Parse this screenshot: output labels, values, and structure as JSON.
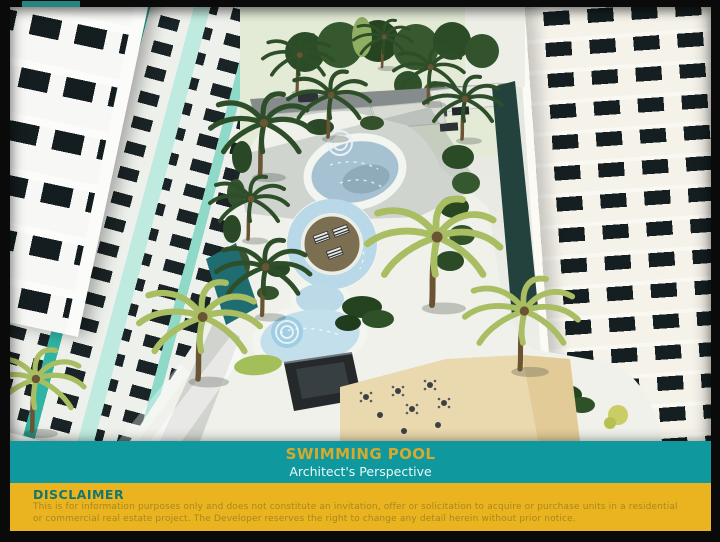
{
  "slide": {
    "image_alt": "Aerial architect's rendering of a free-form swimming pool courtyard with palm trees, lounger island and amenity deck between mid-rise residential towers",
    "caption": {
      "title": "SWIMMING POOL",
      "subtitle": "Architect's Perspective"
    },
    "disclaimer": {
      "heading": "DISCLAIMER",
      "line1": "This is for information purposes only and does not constitute an invitation, offer or solicitation to acquire or purchase units in a residential",
      "line2": "or commercial real estate project. The Developer reserves the right to change any detail herein without prior notice."
    }
  },
  "colors": {
    "frame_black": "#0a0a0a",
    "banner_teal": "#0f989e",
    "banner_title": "#d5aa2d",
    "banner_subtitle": "#e9fbf8",
    "disclaimer_bg": "#e9b41f",
    "disclaimer_heading": "#16756d",
    "disclaimer_text": "#a8871f",
    "pool_water": "#b9d8e8",
    "mint_facade": "#8fd9c8",
    "teal_facade": "#2fb4a4",
    "palm_dark": "#2e4e29",
    "palm_light": "#a9bd62"
  }
}
